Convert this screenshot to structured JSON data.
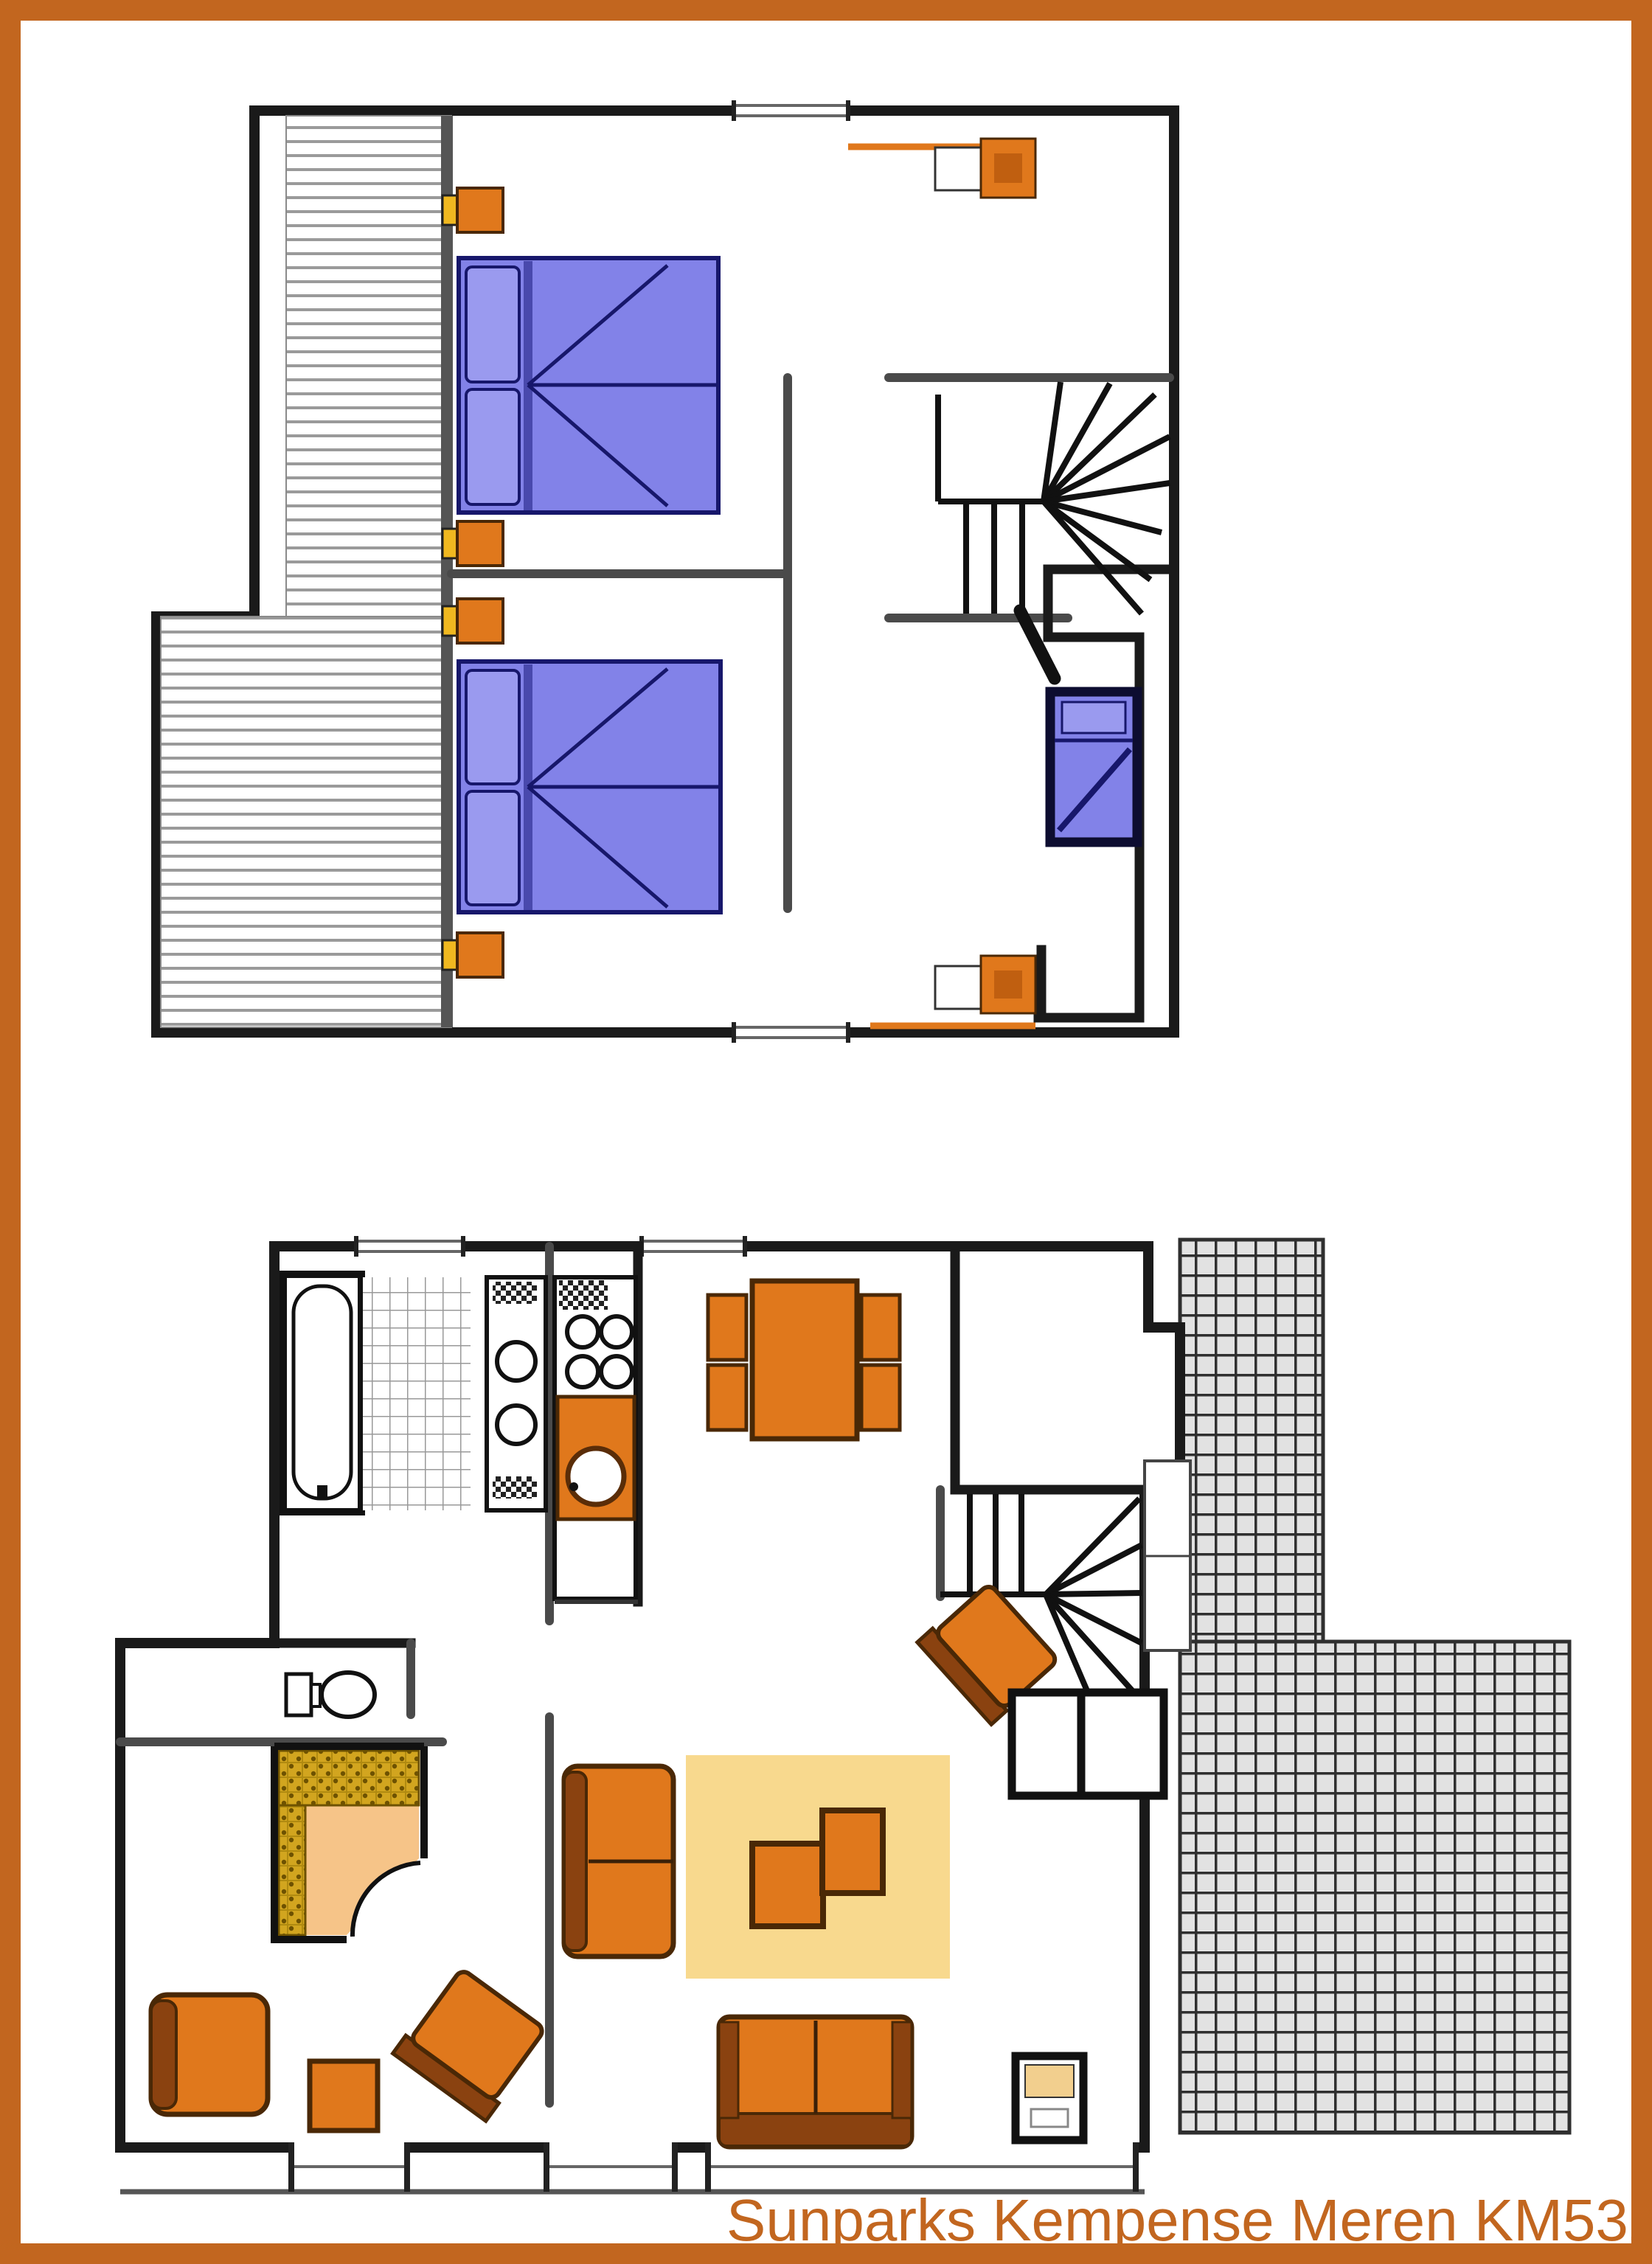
{
  "caption": "Sunparks Kempense Meren KM532",
  "colors": {
    "frame": "#c2661f",
    "accent": "#c2661f",
    "wall": "#1a1a1a",
    "part": "#4a4a4a",
    "orange": "#e0781c",
    "brown": "#4a2806",
    "darkback": "#8a4210",
    "bed": "#8282e8",
    "navy": "#17176b",
    "pillow": "#9a9aef",
    "lamp": "#f0b820",
    "rug": "#f8d98e",
    "bench": "#d2a51f",
    "saunafloor": "#f6c488",
    "tileline": "#2f2f2f",
    "tilebg": "#e2e2e2"
  },
  "floors": [
    {
      "name": "upper-floor",
      "rooms": [
        "bedroom-1",
        "bedroom-2",
        "landing",
        "cot-closet",
        "sloped-roof-zone",
        "stairwell"
      ],
      "furniture": [
        "double-bed-1",
        "double-bed-2",
        "cot-bed",
        "nightstand-lamp-1",
        "nightstand-lamp-2",
        "nightstand-lamp-3",
        "nightstand-lamp-4",
        "dresser-top",
        "dresser-bottom"
      ],
      "features": [
        "winder-staircase",
        "door-swing",
        "window-top",
        "window-bottom"
      ]
    },
    {
      "name": "ground-floor",
      "rooms": [
        "bathroom",
        "kitchen",
        "dining-area",
        "entrance-hall",
        "stair-hall",
        "storage-cells",
        "sauna-room",
        "wc",
        "living-room",
        "terrace"
      ],
      "furniture": [
        "bathtub",
        "vanity-two-sinks",
        "hob-four-burners",
        "kitchen-counter-sink",
        "dining-table",
        "dining-chairs-4",
        "hall-chair",
        "sauna-cabin",
        "toilet",
        "armchair",
        "side-stool",
        "lounge-chair",
        "loveseat",
        "coffee-table-pair",
        "rug",
        "sofa",
        "tv-table"
      ],
      "features": [
        "winder-staircase",
        "terrace-tiles",
        "patio-door",
        "windows"
      ]
    }
  ]
}
